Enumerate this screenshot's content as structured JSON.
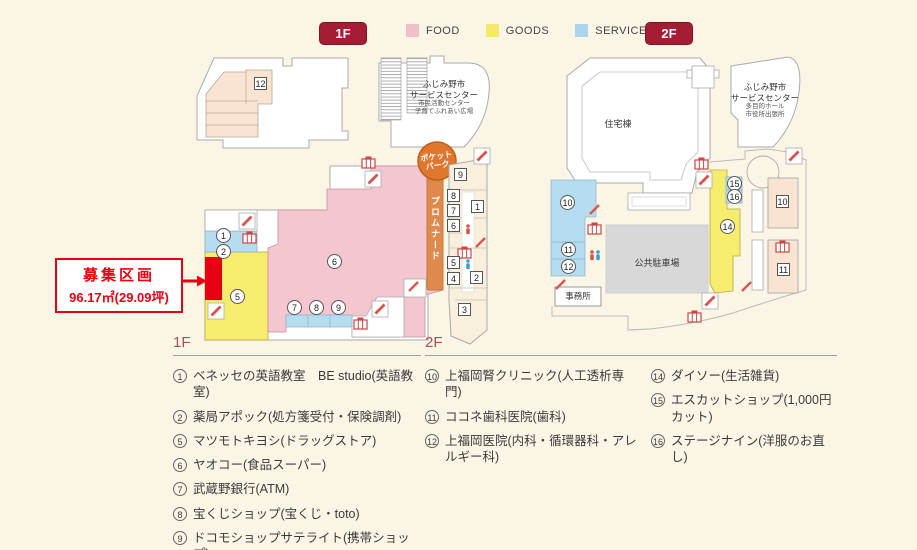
{
  "legend": {
    "floor1_badge": "1F",
    "floor2_badge": "2F",
    "items": [
      {
        "label": "FOOD",
        "color": "#efc0ca"
      },
      {
        "label": "GOODS",
        "color": "#f4e96d"
      },
      {
        "label": "SERVICE",
        "color": "#abd5ec"
      }
    ]
  },
  "callout": {
    "title": "募集区画",
    "area": "96.17㎡(29.09坪)",
    "color": "#e60012"
  },
  "map_1f": {
    "building12_label": "12",
    "service_center": {
      "line1": "ふじみ野市",
      "line2": "サービスセンター",
      "line3": "市民活動センター",
      "line4": "子育てふれあい広場"
    },
    "pocket_park": {
      "line1": "ポケット",
      "line2": "パーク"
    },
    "promenade_label": "プロムナード",
    "circle_units": {
      "c1": "1",
      "c2": "2",
      "c5": "5",
      "c6": "6",
      "c7": "7",
      "c8": "8",
      "c9": "9"
    },
    "square_units": {
      "s1": "1",
      "s2": "2",
      "s3": "3",
      "s4": "4",
      "s5": "5",
      "s6": "6",
      "s7": "7",
      "s8": "8",
      "s9": "9"
    }
  },
  "map_2f": {
    "residential_label": "住宅棟",
    "service_center": {
      "line1": "ふじみ野市",
      "line2": "サービスセンター",
      "line3": "多目的ホール",
      "line4": "市役所出張所"
    },
    "office_label": "事務所",
    "parking_label": "公共駐車場",
    "circle_units": {
      "c10": "10",
      "c11": "11",
      "c12": "12",
      "c14": "14",
      "c15": "15",
      "c16": "16"
    },
    "square_units": {
      "s10": "10",
      "s11": "11"
    }
  },
  "directory_1f": {
    "heading": "1F",
    "items": [
      {
        "num": "1",
        "name": "ベネッセの英語教室　BE studio(英語教室)"
      },
      {
        "num": "2",
        "name": "薬局アポック(処方箋受付・保険調剤)"
      },
      {
        "num": "5",
        "name": "マツモトキヨシ(ドラッグストア)"
      },
      {
        "num": "6",
        "name": "ヤオコー(食品スーパー)"
      },
      {
        "num": "7",
        "name": "武蔵野銀行(ATM)"
      },
      {
        "num": "8",
        "name": "宝くじショップ(宝くじ・toto)"
      },
      {
        "num": "9",
        "name": "ドコモショップサテライト(携帯ショップ)"
      }
    ]
  },
  "directory_2f": {
    "heading": "2F",
    "col1": [
      {
        "num": "10",
        "name": "上福岡腎クリニック(人工透析専門)"
      },
      {
        "num": "11",
        "name": "ココネ歯科医院(歯科)"
      },
      {
        "num": "12",
        "name": "上福岡医院(内科・循環器科・アレルギー科)"
      }
    ],
    "col2": [
      {
        "num": "14",
        "name": "ダイソー(生活雑貨)"
      },
      {
        "num": "15",
        "name": "エスカットショップ(1,000円カット)"
      },
      {
        "num": "16",
        "name": "ステージナイン(洋服のお直し)"
      }
    ]
  }
}
